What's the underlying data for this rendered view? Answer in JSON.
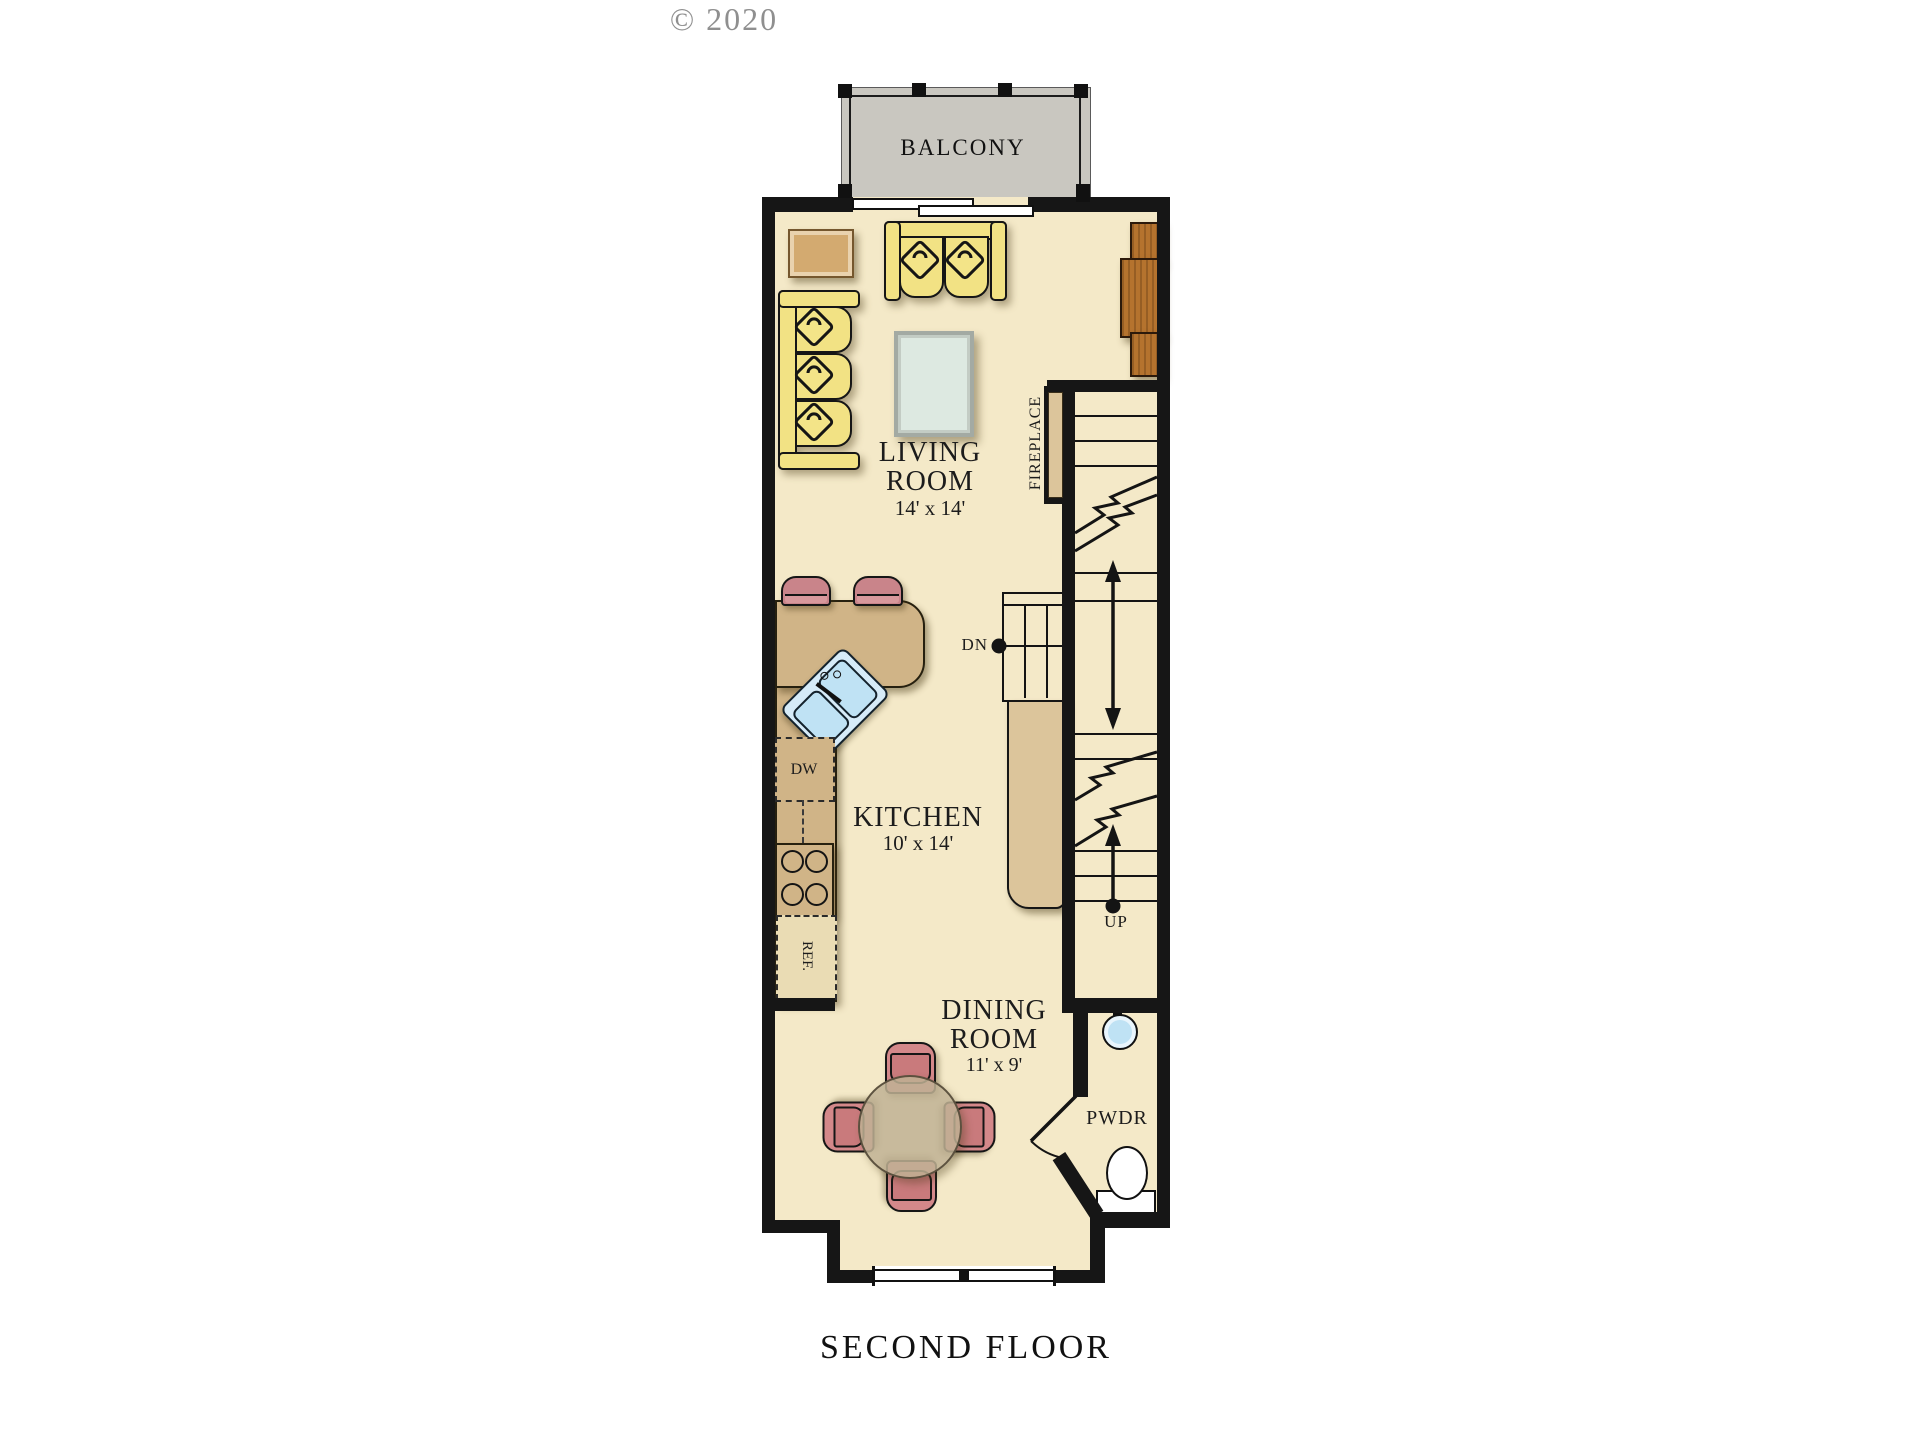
{
  "meta": {
    "copyright": "© 2020",
    "title": "SECOND FLOOR"
  },
  "rooms": {
    "balcony": {
      "label": "BALCONY"
    },
    "living": {
      "line1": "LIVING",
      "line2": "ROOM",
      "dims": "14' x 14'"
    },
    "kitchen": {
      "line1": "KITCHEN",
      "dims": "10' x 14'"
    },
    "dining": {
      "line1": "DINING",
      "line2": "ROOM",
      "dims": "11' x 9'"
    },
    "powder": {
      "label": "PWDR"
    }
  },
  "annotations": {
    "fireplace": "FIREPLACE",
    "dishwasher": "DW",
    "refrigerator": "REF.",
    "stairs_down": "DN",
    "stairs_up": "UP"
  },
  "icons": [
    "balcony-railing-icon",
    "sliding-door-icon",
    "loveseat-icon",
    "sofa-icon",
    "end-table-icon",
    "coffee-table-icon",
    "media-console-icon",
    "fireplace-icon",
    "stair-treads-icon",
    "stair-arrow-icon",
    "kitchen-peninsula-icon",
    "corner-sink-icon",
    "range-burners-icon",
    "bar-stool-icon",
    "dining-table-icon",
    "dining-chair-icon",
    "window-icon",
    "door-swing-icon",
    "toilet-icon",
    "round-sink-icon"
  ],
  "colors": {
    "floor": "#f4e9c8",
    "wall": "#161616",
    "counter": "#d0b487",
    "cabinet_light": "#eadcb4",
    "wood_console": "#b5732e",
    "sofa_yellow": "#f2e284",
    "seat_pink": "#d4888a",
    "table_tan": "#c0b294",
    "water_blue": "#bfe2f4",
    "balcony_gray": "#c9c7c0",
    "coffee_table": "#dde9e1",
    "end_table": "#d3aa70",
    "rail_tan": "#dcc59b",
    "text": "#1c1c1c",
    "copyright_gray": "#8f8f8f"
  }
}
